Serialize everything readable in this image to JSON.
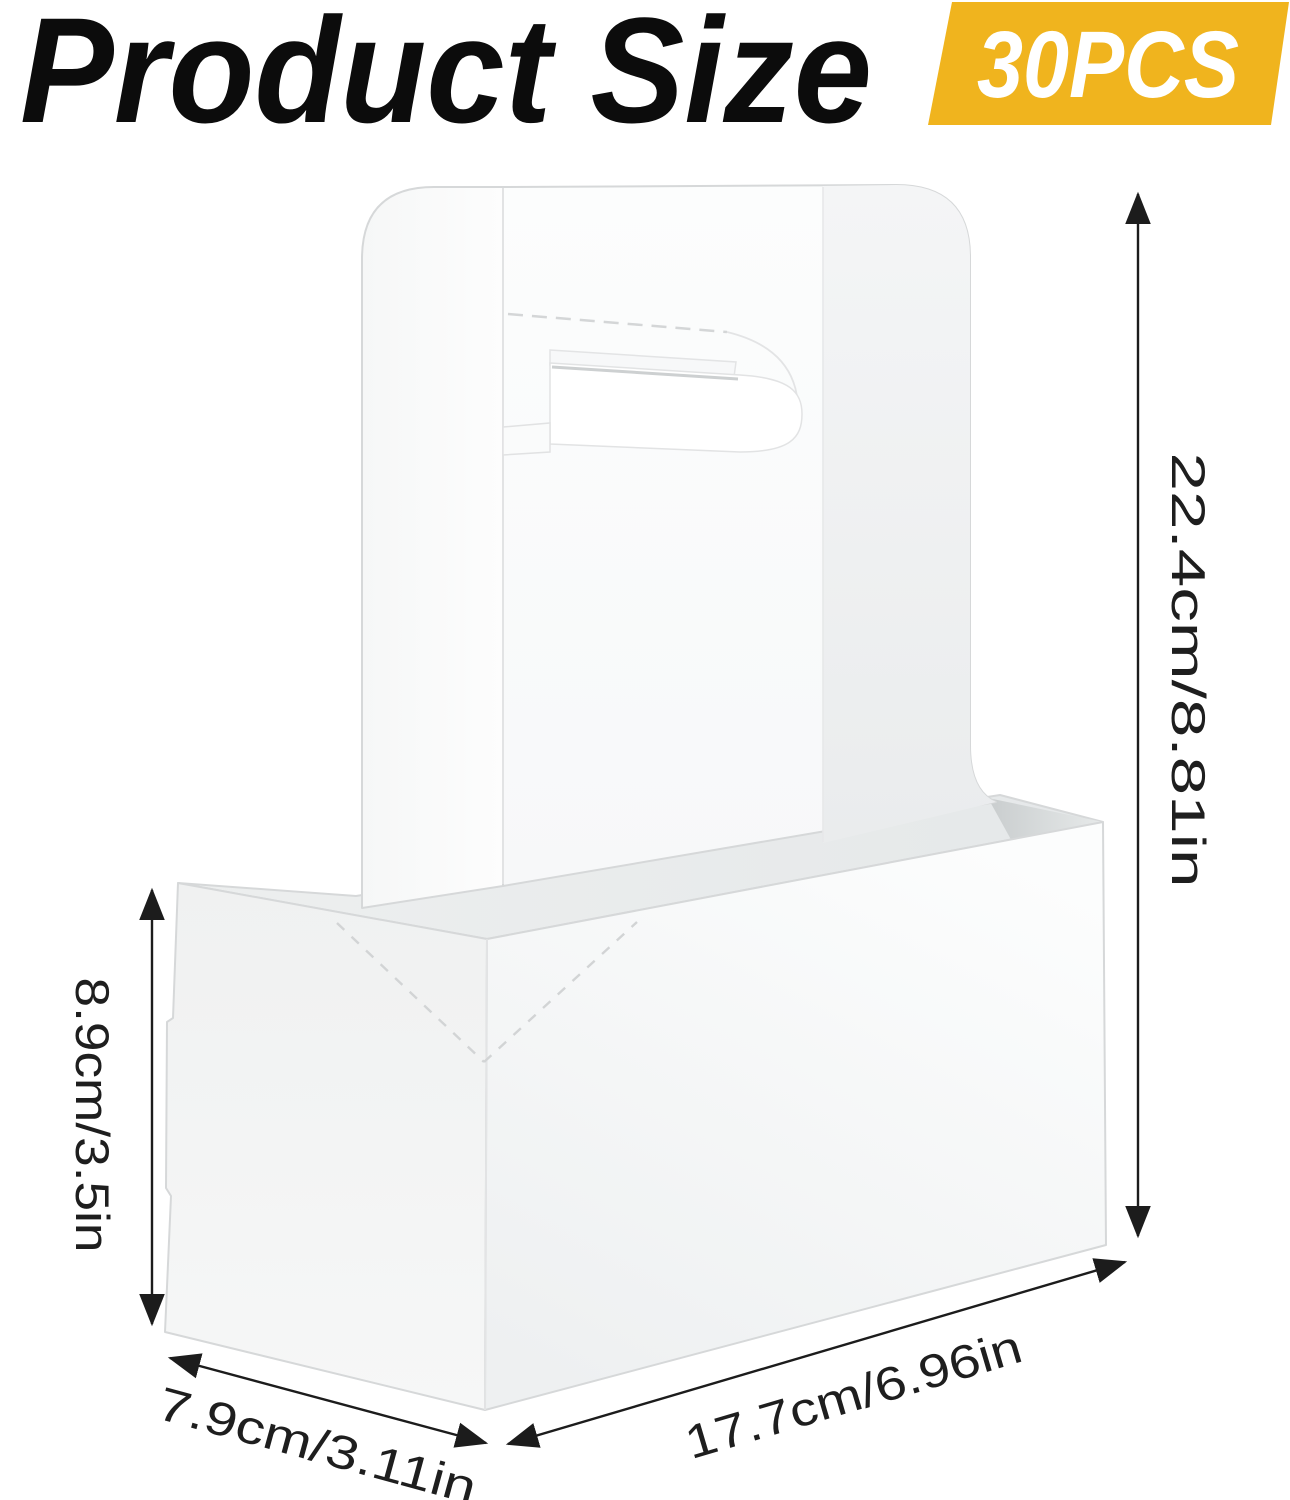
{
  "header": {
    "title": "Product Size",
    "badge_label": "30PCS",
    "badge_color": "#F0B41E"
  },
  "dimensions": {
    "overall_height": "22.4cm/8.81in",
    "box_height": "8.9cm/3.5in",
    "box_depth": "7.9cm/3.11in",
    "box_width": "17.7cm/6.96in"
  },
  "illustration": {
    "subject": "white paper two-cup drink carrier with fold-up handle and hand hole"
  },
  "colors": {
    "dimension_line": "#1c1c1c",
    "background": "#ffffff"
  }
}
